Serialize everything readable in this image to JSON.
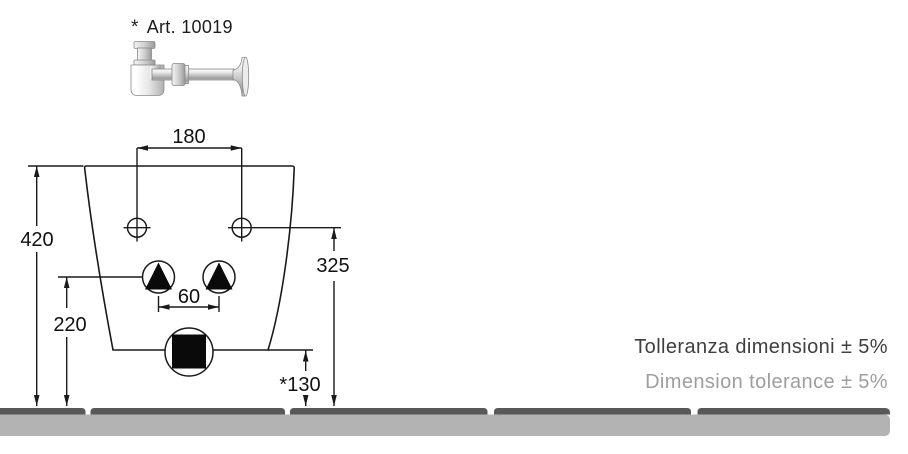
{
  "header": {
    "asterisk": "*",
    "article": "Art. 10019"
  },
  "dimensions": {
    "hole_spacing": "180",
    "overall_height": "420",
    "supply_height": "220",
    "supply_spacing": "60",
    "fixing_height": "325",
    "outlet_height": "*130"
  },
  "tolerance": {
    "italian": "Tolleranza dimensioni ± 5%",
    "english": "Dimension tolerance ± 5%"
  },
  "colors": {
    "line": "#1a1a1a",
    "floor_top": "#58585a",
    "floor_body": "#b3b3b3",
    "tolerance_primary": "#3f3f3f",
    "tolerance_secondary": "#9e9e9e"
  }
}
